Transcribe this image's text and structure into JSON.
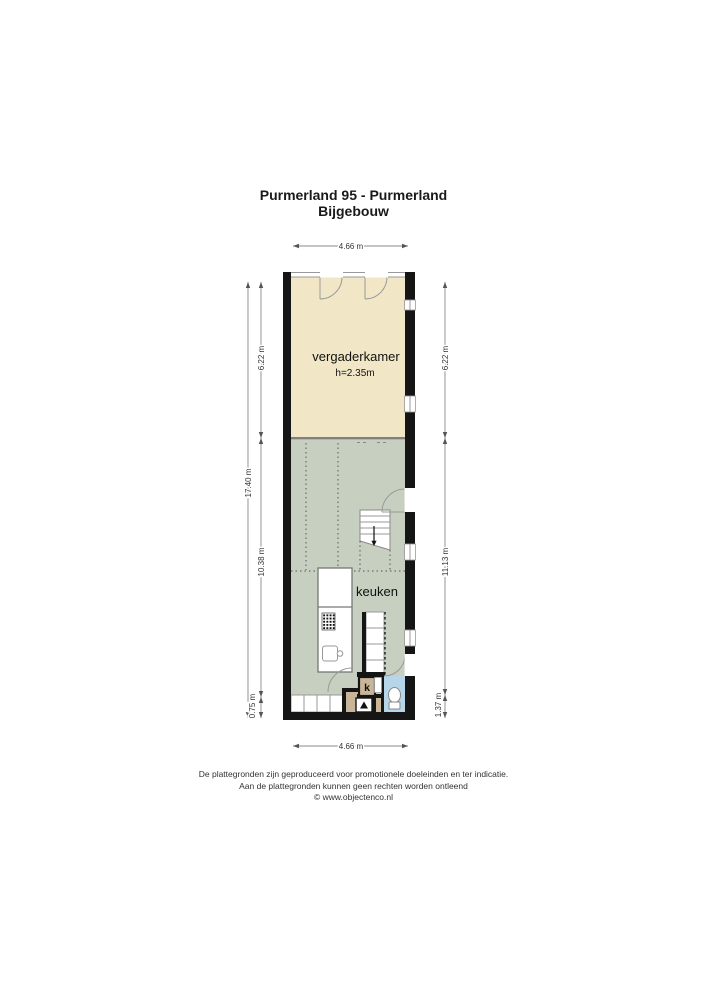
{
  "title": {
    "line1": "Purmerland 95 - Purmerland",
    "line2": "Bijgebouw"
  },
  "rooms": {
    "vergaderkamer": {
      "label": "vergaderkamer",
      "height": "h=2.35m"
    },
    "keuken": {
      "label": "keuken"
    },
    "kast": {
      "label": "k"
    }
  },
  "dimensions": {
    "top": "4.66 m",
    "bottom": "4.66 m",
    "left_total": "17.40 m",
    "left_segments": [
      "6.22 m",
      "10.38 m",
      "0.75 m"
    ],
    "right_segments": [
      "6.22 m",
      "11.13 m",
      "1.37 m"
    ]
  },
  "colors": {
    "wall": "#151515",
    "vergaderkamer": "#f1e7c6",
    "keuken": "#c6cfc0",
    "hal": "#c9b698",
    "badkamer": "#b7d5e8"
  },
  "footer": {
    "line1": "De plattegronden zijn geproduceerd voor promotionele doeleinden en ter indicatie.",
    "line2": "Aan de plattegronden kunnen geen rechten worden ontleend",
    "line3": "© www.objectenco.nl"
  }
}
